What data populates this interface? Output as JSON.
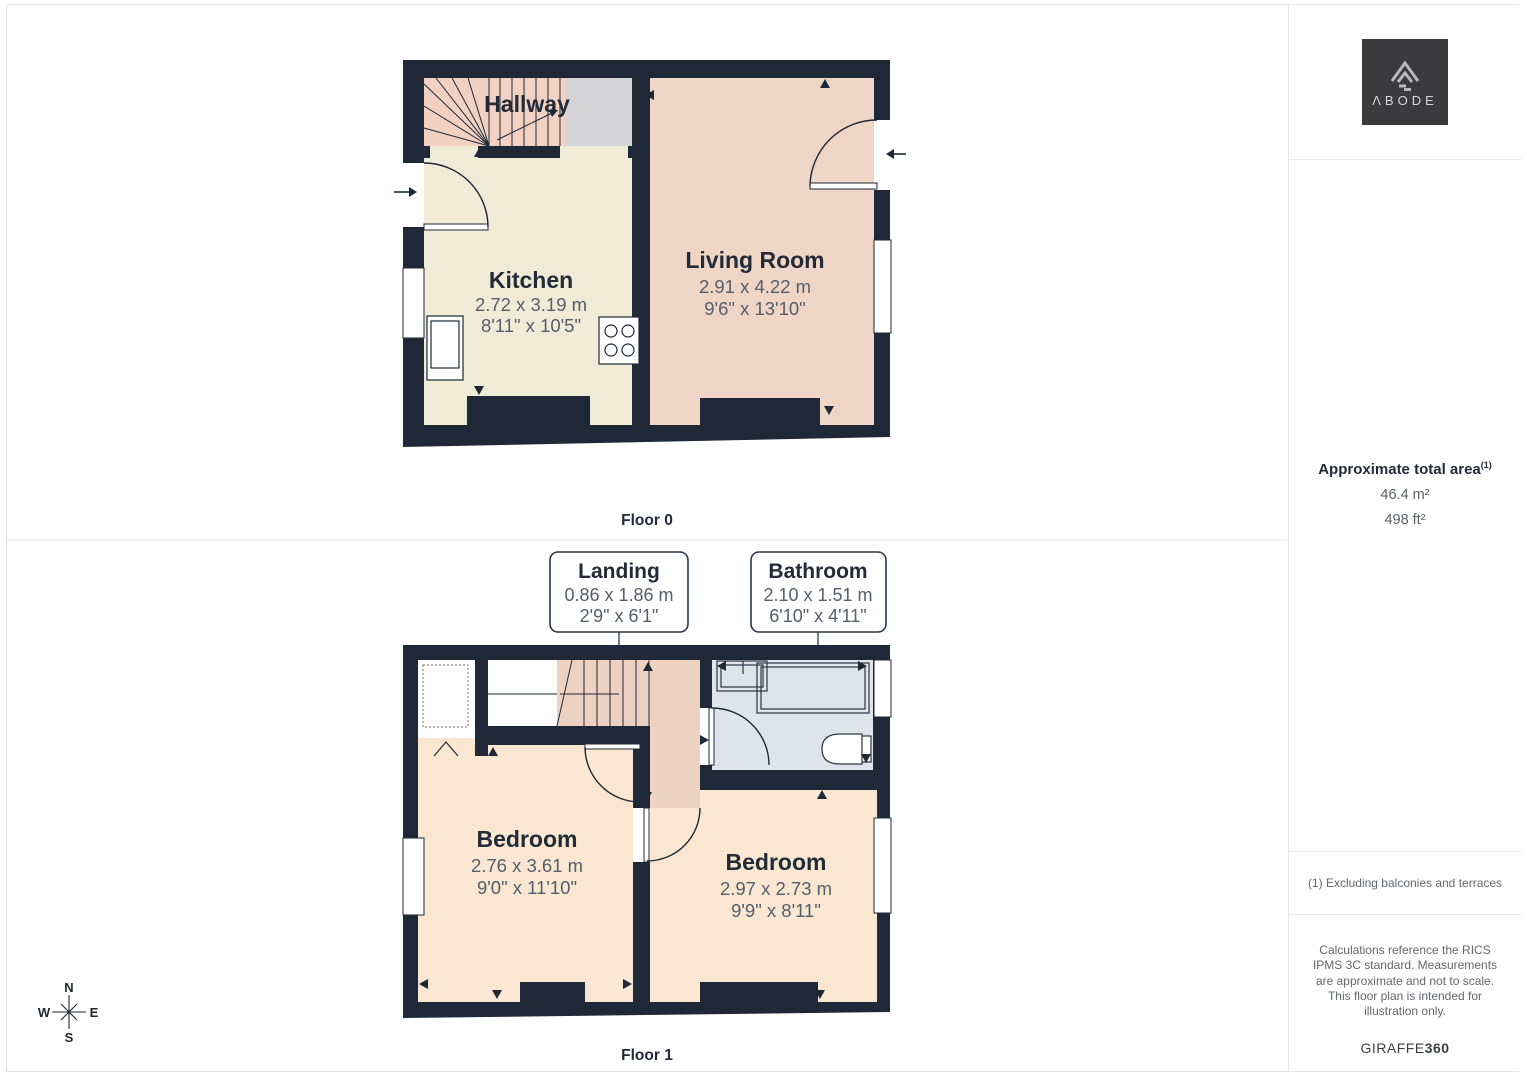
{
  "page": {
    "floor0_label": "Floor 0",
    "floor1_label": "Floor 1"
  },
  "floor0": {
    "hallway": {
      "name": "Hallway"
    },
    "kitchen": {
      "name": "Kitchen",
      "dim_m": "2.72 x 3.19 m",
      "dim_ft": "8'11\" x 10'5\""
    },
    "living_room": {
      "name": "Living Room",
      "dim_m": "2.91 x 4.22 m",
      "dim_ft": "9'6\" x 13'10\""
    }
  },
  "floor1": {
    "bedroom_left": {
      "name": "Bedroom",
      "dim_m": "2.76 x 3.61 m",
      "dim_ft": "9'0\" x 11'10\""
    },
    "bedroom_right": {
      "name": "Bedroom",
      "dim_m": "2.97 x 2.73 m",
      "dim_ft": "9'9\" x 8'11\""
    },
    "landing_callout": {
      "name": "Landing",
      "dim_m": "0.86 x 1.86 m",
      "dim_ft": "2'9\" x 6'1\""
    },
    "bathroom_callout": {
      "name": "Bathroom",
      "dim_m": "2.10 x 1.51 m",
      "dim_ft": "6'10\" x 4'11\""
    }
  },
  "compass": {
    "north": "N",
    "east": "E",
    "south": "S",
    "west": "W"
  },
  "sidebar": {
    "logo_text": "ΛBODE",
    "area_title": "Approximate total area",
    "area_sup": "(1)",
    "area_metric": "46.4 m²",
    "area_imperial": "498 ft²",
    "footnote": "(1) Excluding balconies and terraces",
    "disclaimer": "Calculations reference the RICS IPMS 3C standard. Measurements are approximate and not to scale. This floor plan is intended for illustration only.",
    "brand_name": "GIRAFFE",
    "brand_suffix": "360"
  },
  "colors": {
    "wall": "#1e2836",
    "kitchen_floor": "#f0ebd7",
    "living_floor": "#eed5c6",
    "hallway_floor": "#f2d1c2",
    "stair_gray": "#d4d4d7",
    "bedroom_floor": "#f9e7d1",
    "landing_floor": "#edd2c1",
    "bathroom_floor": "#dfe3ec"
  }
}
